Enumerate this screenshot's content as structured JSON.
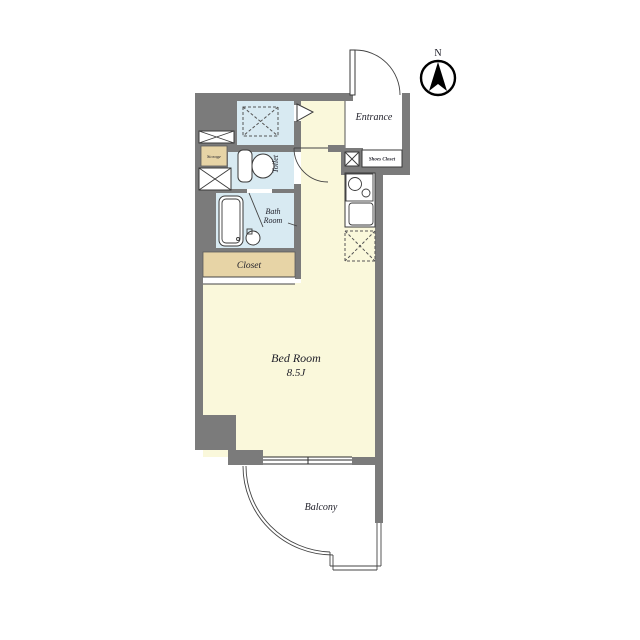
{
  "title": "apartment-floor-plan",
  "compass": {
    "north": "N"
  },
  "labels": {
    "entrance": "Entrance",
    "shoes_closet": "Shoes Closet",
    "storage": "Storage",
    "toilet": "Toilet",
    "bath_line1": "Bath",
    "bath_line2": "Room",
    "closet": "Closet",
    "bedroom": "Bed Room",
    "bedroom_size": "8.5J",
    "balcony": "Balcony"
  },
  "colors": {
    "wall": "#7b7b7b",
    "floor_main": "#faf8db",
    "floor_wet": "#d8eaf2",
    "closet_fill": "#e7d4a6",
    "background": "#ffffff",
    "line": "#1e1e28"
  }
}
